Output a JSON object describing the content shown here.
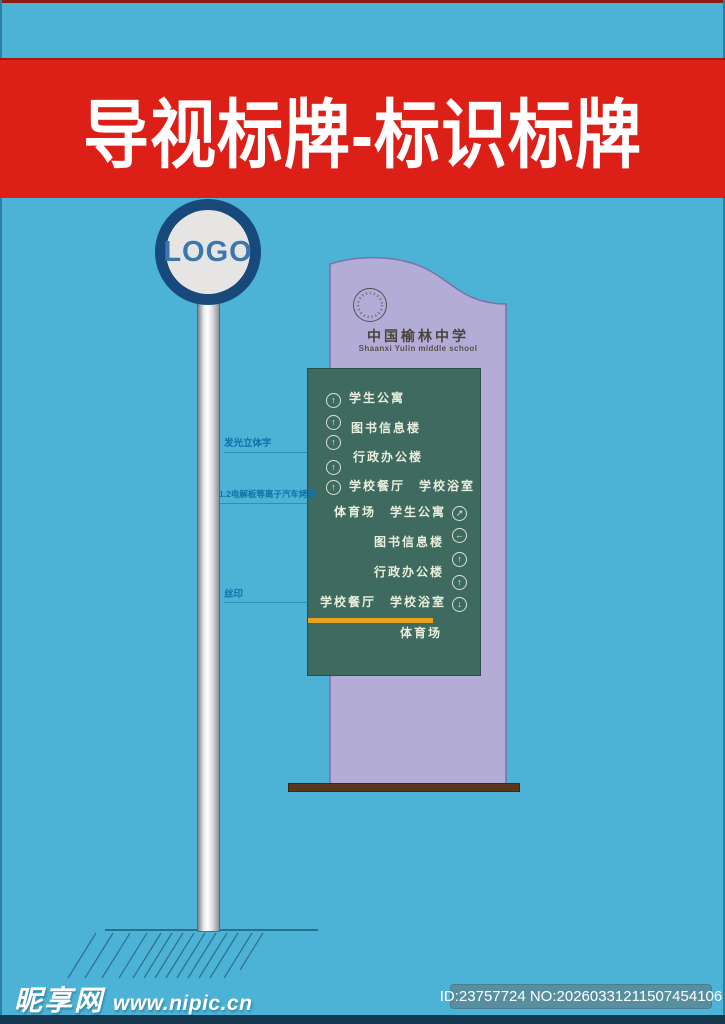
{
  "banner": {
    "title": "导视标牌-标识标牌",
    "bg_color": "#dc2017",
    "text_color": "#ffffff"
  },
  "logo_sign": {
    "label": "LOGO",
    "ring_color": "#17497b",
    "text_color": "#3a77ae"
  },
  "board": {
    "school_name_cn": "中国榆林中学",
    "school_name_en": "Shaanxi Yulin middle school",
    "body_color": "#b3acd6",
    "panel_color": "#3e6a60",
    "accent_bar_color": "#e7a11e",
    "base_color": "#59371c"
  },
  "directory": {
    "left_arrows": [
      "↑",
      "↑",
      "↑",
      "↑",
      "↑"
    ],
    "left_labels": [
      "学生公寓",
      "图书信息楼",
      "行政办公楼",
      "学校餐厅　学校浴室"
    ],
    "right_labels": [
      "体育场　学生公寓",
      "图书信息楼",
      "行政办公楼",
      "学校餐厅　学校浴室"
    ],
    "right_arrows": [
      "↗",
      "←",
      "↑",
      "↑",
      "↓"
    ],
    "bottom_label": "体育场"
  },
  "annotations": [
    {
      "text": "发光立体字"
    },
    {
      "text": "1.2电解板等离子汽车烤漆"
    },
    {
      "text": "丝印"
    }
  ],
  "footer": {
    "site_name": "昵享网",
    "site_url": "www.nipic.cn",
    "id_text": "ID:23757724 NO:20260331211507454106"
  },
  "page_bg": "#4cb2d6"
}
